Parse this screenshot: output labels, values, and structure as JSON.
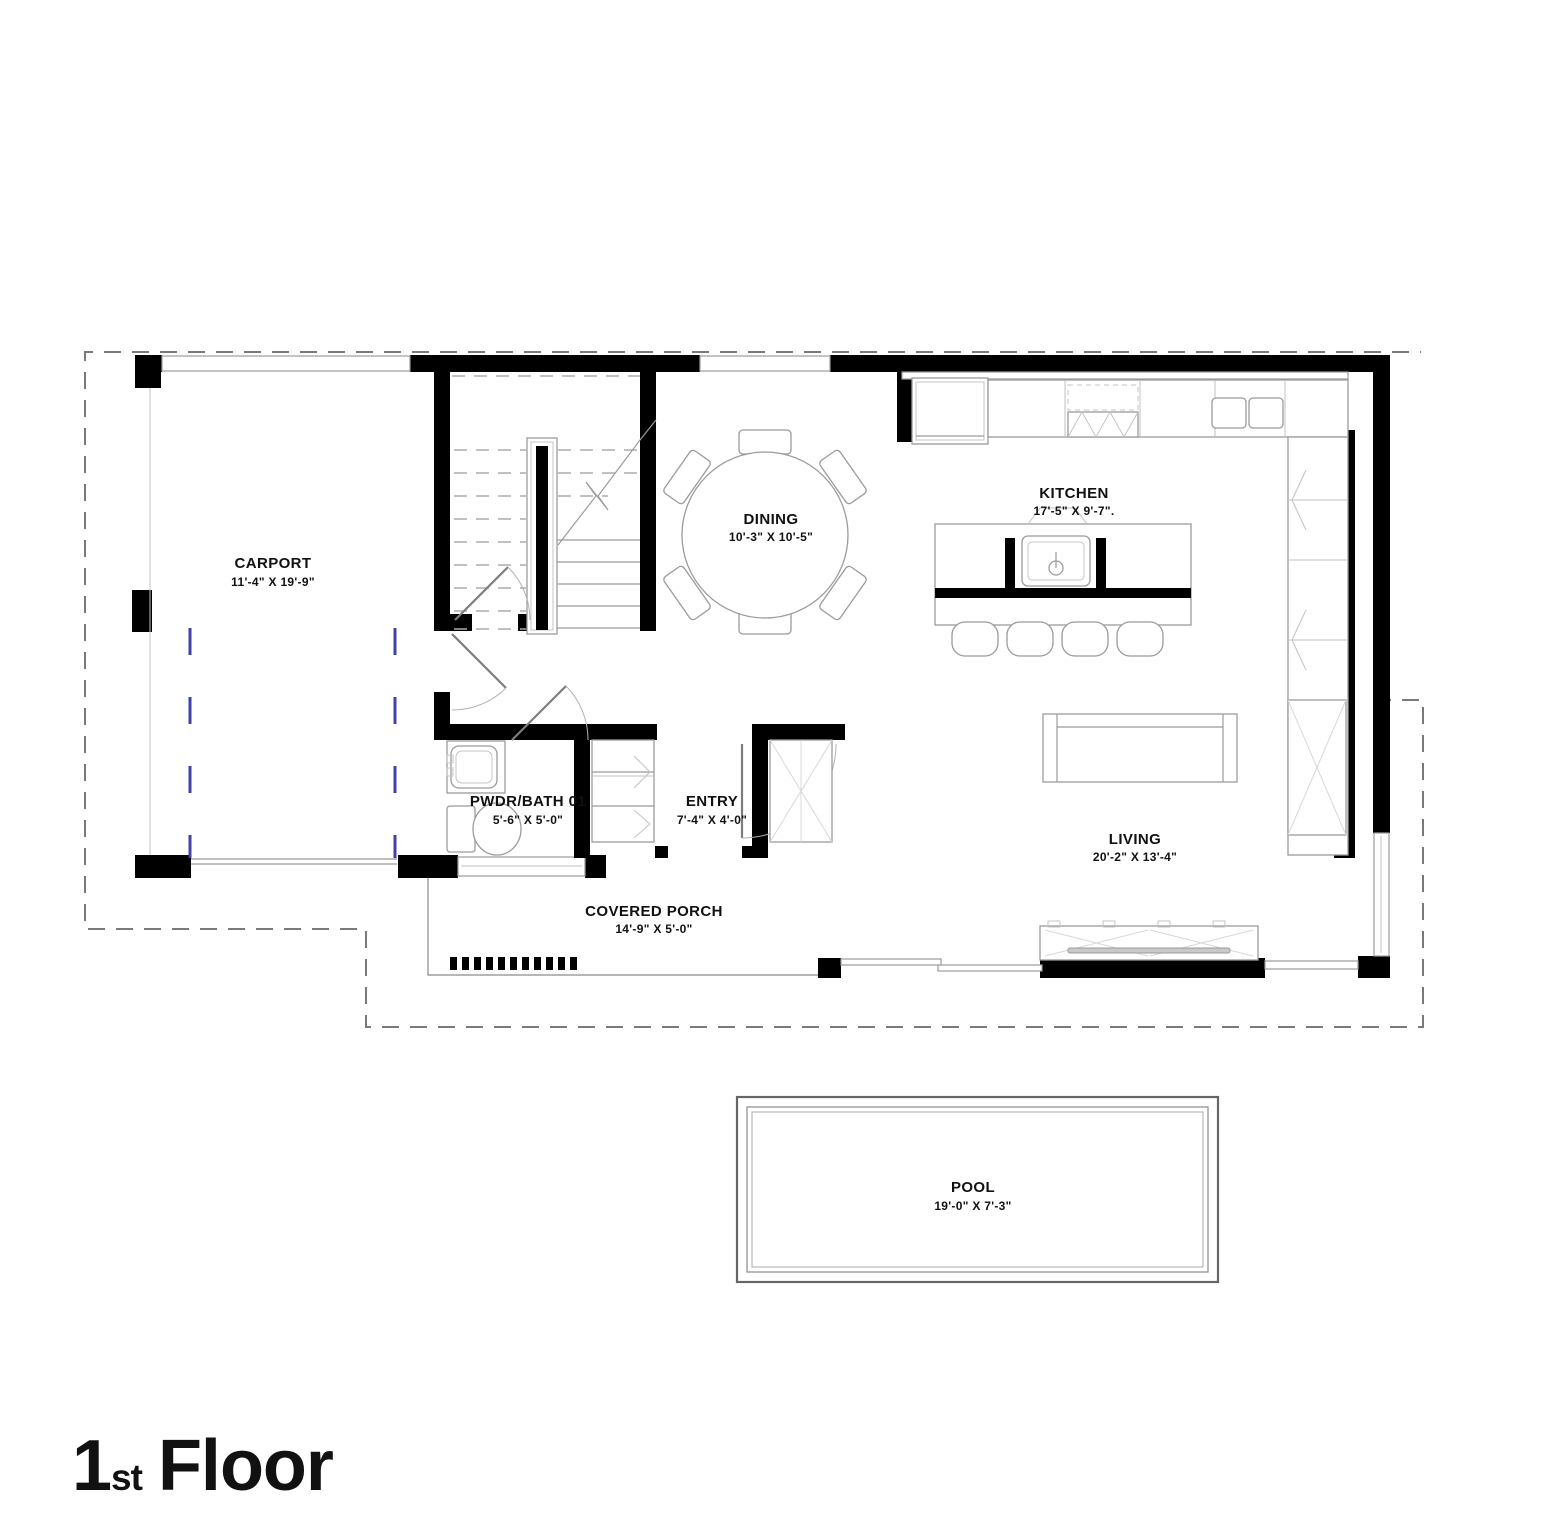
{
  "title": {
    "number": "1",
    "ordinal": "st",
    "word": "Floor"
  },
  "rooms": {
    "carport": {
      "name": "CARPORT",
      "dims": "11'-4\" X 19'-9\""
    },
    "dining": {
      "name": "DINING",
      "dims": "10'-3\" X 10'-5\""
    },
    "kitchen": {
      "name": "KITCHEN",
      "dims": "17'-5\" X 9'-7\"."
    },
    "pwdr_bath": {
      "name": "PWDR/BATH 01",
      "dims": "5'-6\" X 5'-0\""
    },
    "entry": {
      "name": "ENTRY",
      "dims": "7'-4\" X 4'-0\""
    },
    "living": {
      "name": "LIVING",
      "dims": "20'-2\" X 13'-4\""
    },
    "covered_porch": {
      "name": "COVERED PORCH",
      "dims": "14'-9\" X 5'-0\""
    },
    "pool": {
      "name": "POOL",
      "dims": "19'-0\" X 7'-3\""
    }
  },
  "colors": {
    "wall": "#000000",
    "furniture_line": "#9b9b9b",
    "parking_stripe": "#4141a8",
    "boundary_dash": "#7a7a7a",
    "text": "#111111",
    "background": "#ffffff"
  }
}
